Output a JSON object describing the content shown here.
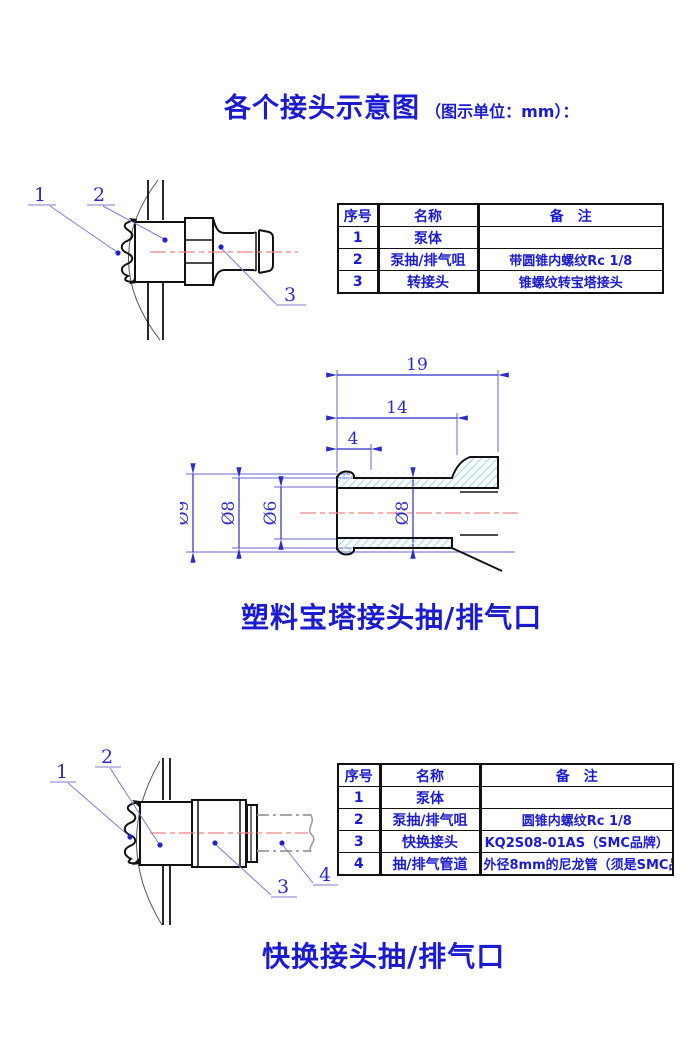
{
  "title": {
    "main": "各个接头示意图",
    "sub": "（图示单位：mm）："
  },
  "captions": {
    "pagoda": "塑料宝塔接头抽/排气口",
    "quick": "快换接头抽/排气口"
  },
  "tables": {
    "pagoda": {
      "headers": [
        "序号",
        "名称",
        "备　注"
      ],
      "rows": [
        [
          "1",
          "泵体",
          ""
        ],
        [
          "2",
          "泵抽/排气咀",
          "带圆锥内螺纹Rc 1/8"
        ],
        [
          "3",
          "转接头",
          "锥螺纹转宝塔接头"
        ]
      ]
    },
    "quick": {
      "headers": [
        "序号",
        "名称",
        "备　注"
      ],
      "rows": [
        [
          "1",
          "泵体",
          ""
        ],
        [
          "2",
          "泵抽/排气咀",
          "圆锥内螺纹Rc 1/8"
        ],
        [
          "3",
          "快换接头",
          "KQ2S08-01AS（SMC品牌）"
        ],
        [
          "4",
          "抽/排气管道",
          "外径8mm的尼龙管（须是SMC品牌）"
        ]
      ]
    }
  },
  "drawings": {
    "pagoda_assembly": {
      "labels": [
        "1",
        "2",
        "3"
      ]
    },
    "quick_assembly": {
      "labels": [
        "1",
        "2",
        "3",
        "4"
      ]
    },
    "section": {
      "dims": {
        "total_len": "19",
        "shaft_len": "14",
        "barb_len": "4",
        "outer_dia": "Ø9",
        "shaft_dia": "Ø8",
        "bore_dia": "Ø6",
        "hole_dia": "Ø8"
      }
    }
  },
  "colors": {
    "accent_blue": "#1b1bd0",
    "dim_blue": "#2c2cc8",
    "line_blue": "#6a6ac8",
    "leader_blue": "#7b7bd0",
    "centerline_red": "#f08585",
    "hatch_cyan": "#a5dcec",
    "outline_black": "#111111"
  }
}
